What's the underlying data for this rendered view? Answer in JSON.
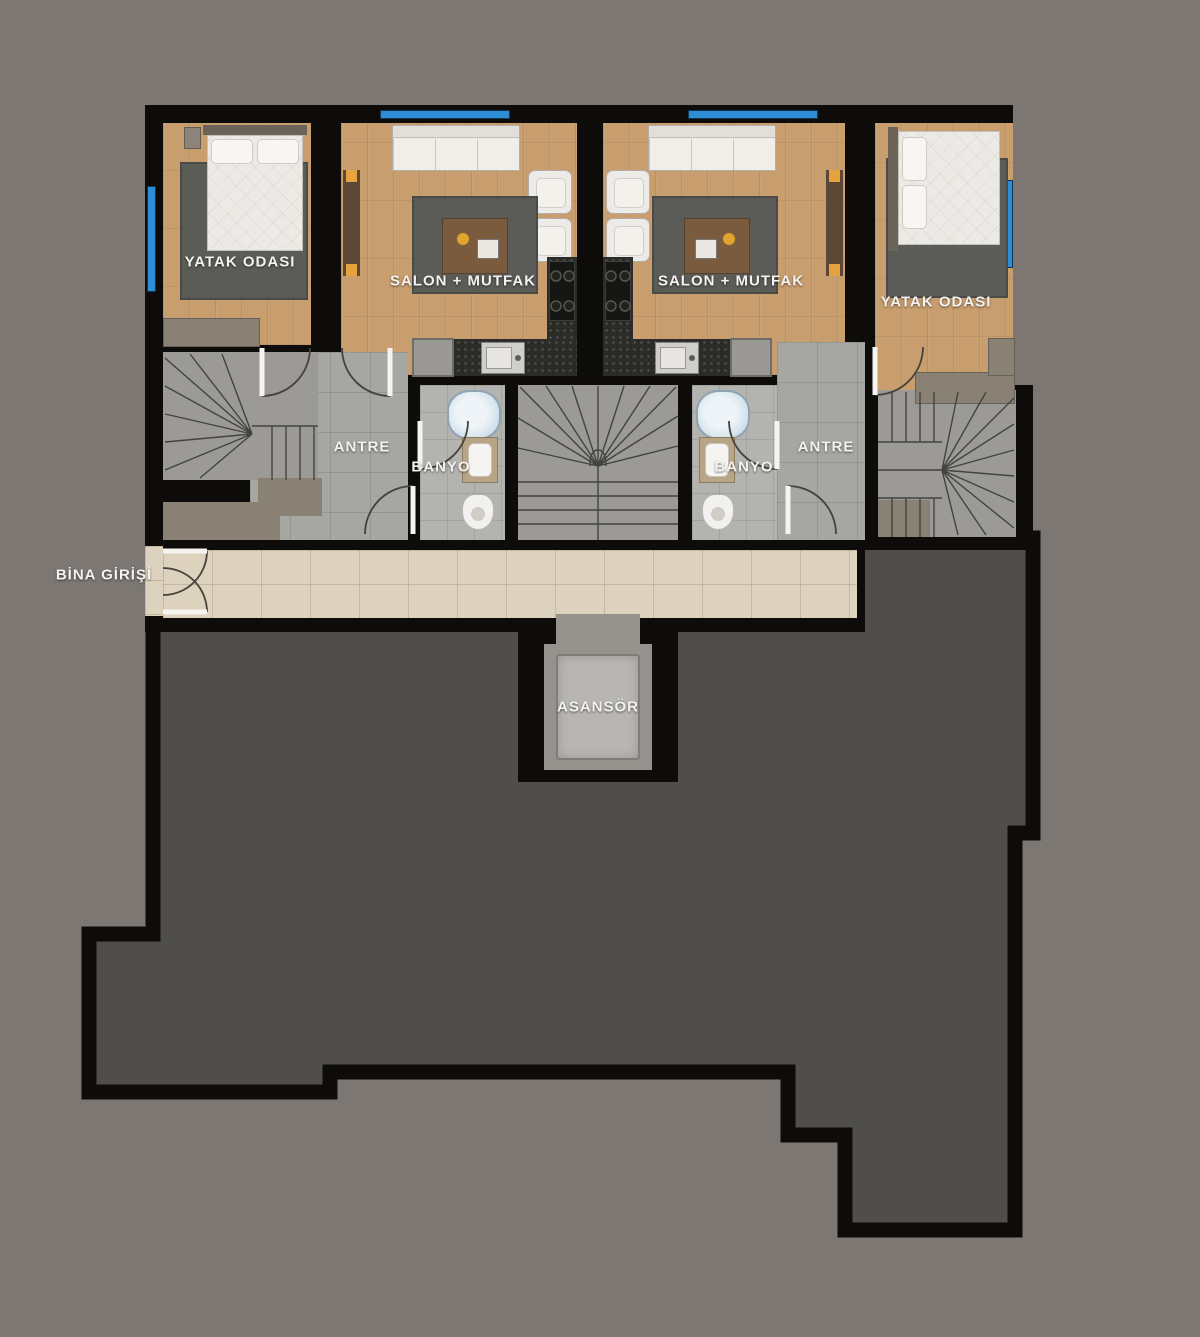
{
  "rooms": {
    "bedroom_left": {
      "label": "YATAK ODASI"
    },
    "salon_left": {
      "label": "SALON + MUTFAK"
    },
    "salon_right": {
      "label": "SALON + MUTFAK"
    },
    "bedroom_right": {
      "label": "YATAK ODASI"
    },
    "antre_left": {
      "label": "ANTRE"
    },
    "antre_right": {
      "label": "ANTRE"
    },
    "banyo_left": {
      "label": "BANYO"
    },
    "banyo_right": {
      "label": "BANYO"
    },
    "entrance": {
      "label": "BİNA GİRİŞİ"
    },
    "elevator": {
      "label": "ASANSÖR"
    }
  },
  "colors": {
    "background": "#7c7772",
    "walls": "#0d0c0a",
    "terrace": "#4f4e4b",
    "wood_floor": "#c89e6e",
    "gray_tile": "#a6a6a3",
    "banyo_tile": "#b3b3b0",
    "corridor_tile": "#ddd2be",
    "window_blue": "#2e8ed5",
    "rug": "#5b5b57",
    "furniture_white": "#edebe7",
    "counter": "#2b2b28",
    "landing_brown": "#8a8175",
    "label_text": "#f4f3f1"
  }
}
